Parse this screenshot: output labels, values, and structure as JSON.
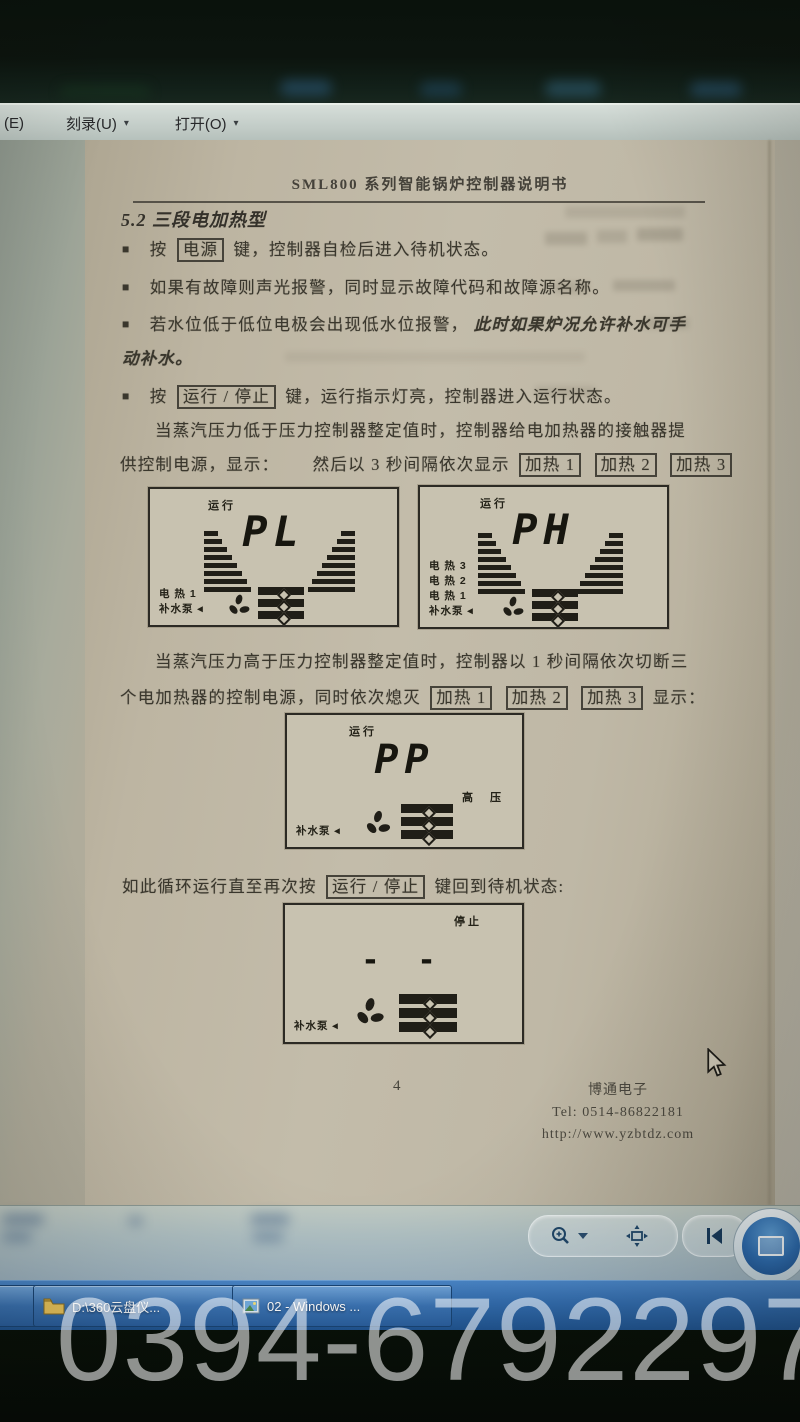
{
  "menu": {
    "m1": "(E)",
    "m2": "刻录(U)",
    "m3": "打开(O)",
    "caret": "▾"
  },
  "doc": {
    "title": "SML800 系列智能锅炉控制器说明书",
    "heading": "5.2 三段电加热型",
    "bullet_glyph": "■",
    "b1_pre": "按",
    "b1_key": "电源",
    "b1_post": "键，控制器自检后进入待机状态。",
    "b2": "如果有故障则声光报警，同时显示故障代码和故障源名称。",
    "b3_pre": "若水位低于低位电极会出现低水位报警，",
    "b3_em": "此时如果炉况允许补水可手",
    "b3_line2": "动补水。",
    "b4_pre": "按",
    "b4_key": "运行 / 停止",
    "b4_post": "键，运行指示灯亮，控制器进入运行状态。",
    "p1_l1": "当蒸汽压力低于压力控制器整定值时，控制器给电加热器的接触器提",
    "p1_l2a": "供控制电源，显示：",
    "p1_l2b": "然后以 3 秒间隔依次显示",
    "heat1": "加热 1",
    "heat2": "加热 2",
    "heat3": "加热 3",
    "p2_l1": "当蒸汽压力高于压力控制器整定值时，控制器以 1 秒间隔依次切断三",
    "p2_l2a": "个电加热器的控制电源，同时依次熄灭",
    "p2_l2b": "显示：",
    "p3_pre": "如此循环运行直至再次按",
    "p3_key": "运行 / 停止",
    "p3_post": "键回到待机状态:"
  },
  "displays": {
    "d1": {
      "status": "运行",
      "value": "PL",
      "labels": [
        "电 热  1",
        "补水泵 ◂"
      ]
    },
    "d2": {
      "status": "运行",
      "value": "PH",
      "labels": [
        "电 热  3",
        "电 热  2",
        "电 热  1",
        "补水泵 ◂"
      ]
    },
    "d3": {
      "status": "运行",
      "value": "PP",
      "side": "高  压",
      "labels": [
        "补水泵 ◂"
      ]
    },
    "d4": {
      "status": "停止",
      "value": "- -",
      "labels": [
        "补水泵 ◂"
      ]
    }
  },
  "footer": {
    "page": "4",
    "company": "博通电子",
    "tel": "Tel: 0514-86822181",
    "url": "http://www.yzbtdz.com"
  },
  "taskbar": {
    "item1": "D:\\360云盘仪...",
    "item2": "02 - Windows ..."
  },
  "watermark": "0394-6792297",
  "colors": {
    "taskbar_blue": "#326cae",
    "page_beige": "#c0b8a5",
    "lcd_ink": "#201e17",
    "watermark_white": "rgba(255,255,255,0.55)"
  }
}
